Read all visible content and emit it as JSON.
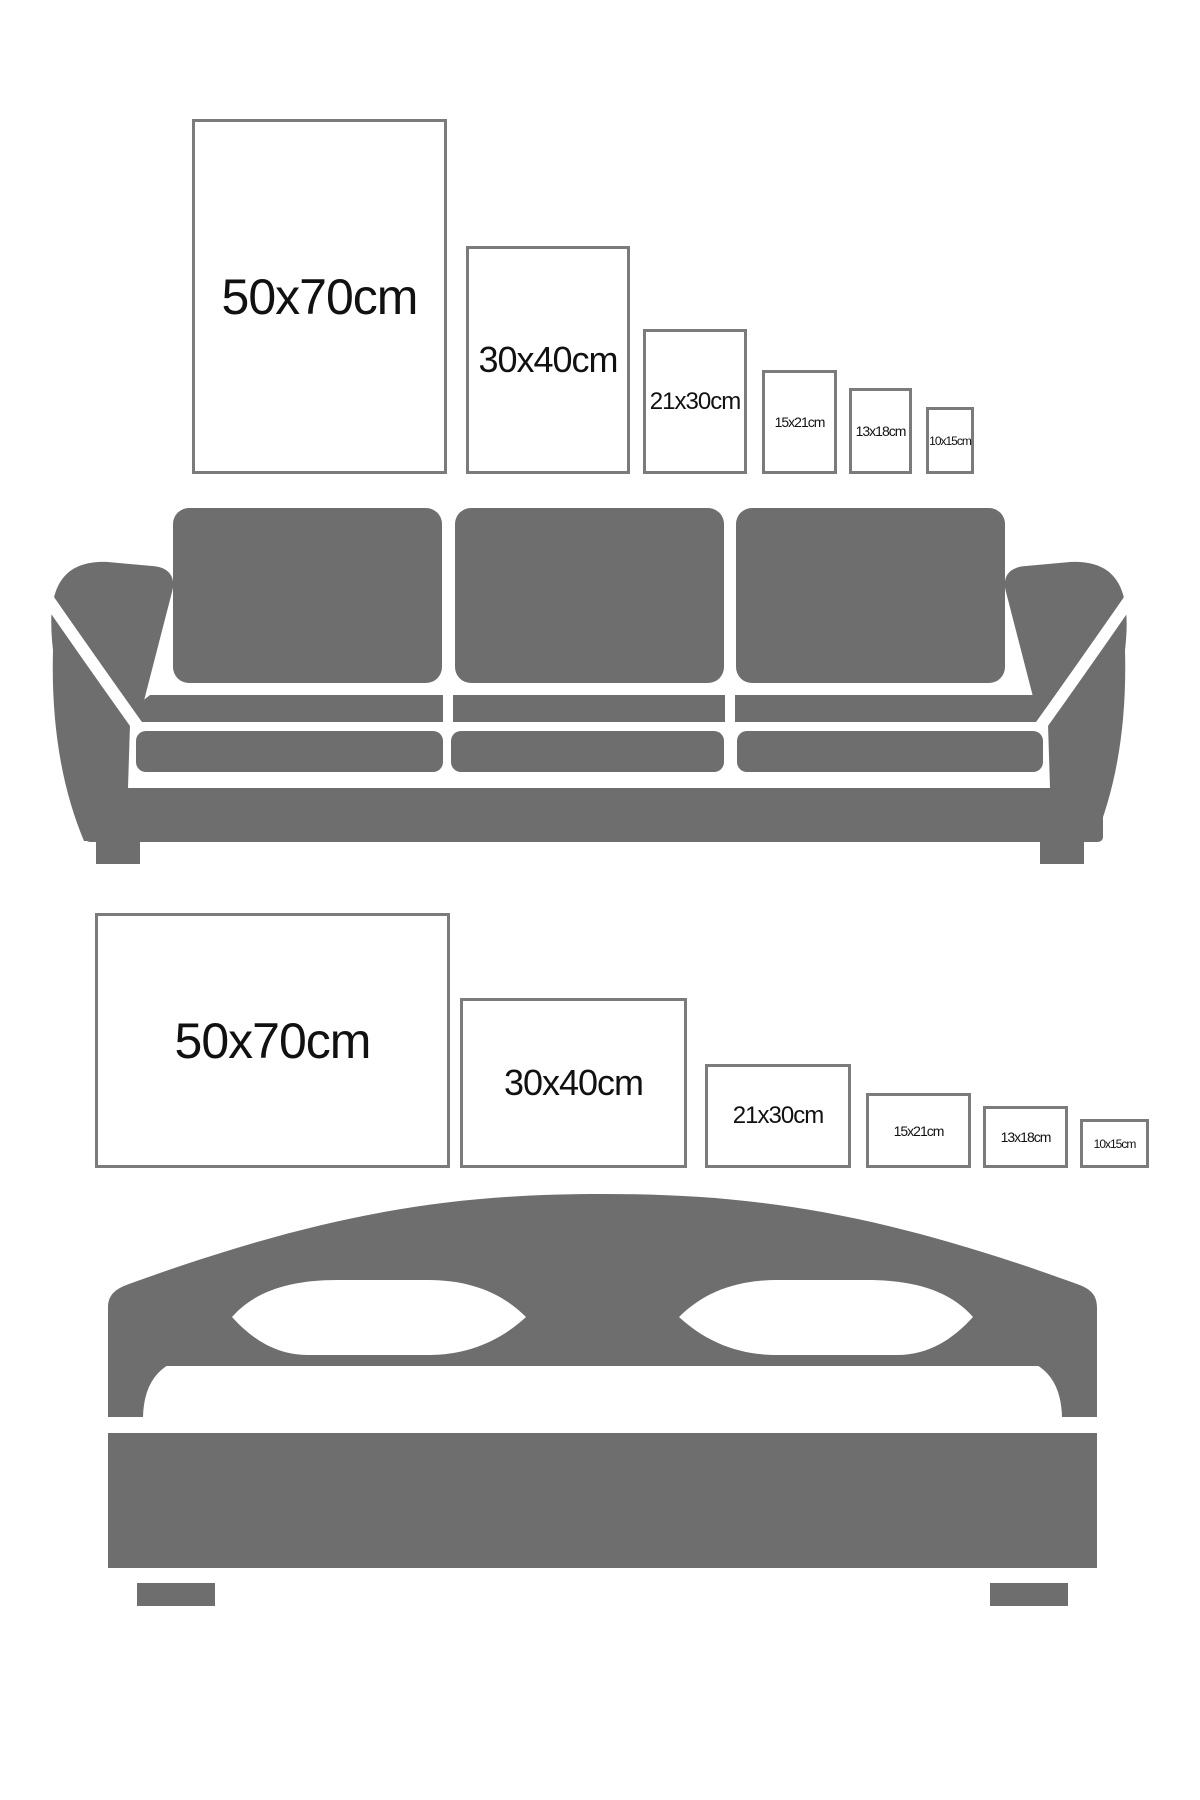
{
  "colors": {
    "background": "#ffffff",
    "furniture_gray": "#6e6e6e",
    "frame_border": "#7b7b7b",
    "frame_fill": "#ffffff",
    "label_text": "#111111"
  },
  "sections": [
    {
      "id": "sofa-size-guide",
      "furniture": "sofa",
      "orientation": "portrait",
      "frames": [
        {
          "label": "50x70cm"
        },
        {
          "label": "30x40cm"
        },
        {
          "label": "21x30cm"
        },
        {
          "label": "15x21cm"
        },
        {
          "label": "13x18cm"
        },
        {
          "label": "10x15cm"
        }
      ]
    },
    {
      "id": "bed-size-guide",
      "furniture": "bed",
      "orientation": "landscape",
      "frames": [
        {
          "label": "50x70cm"
        },
        {
          "label": "30x40cm"
        },
        {
          "label": "21x30cm"
        },
        {
          "label": "15x21cm"
        },
        {
          "label": "13x18cm"
        },
        {
          "label": "10x15cm"
        }
      ]
    }
  ]
}
